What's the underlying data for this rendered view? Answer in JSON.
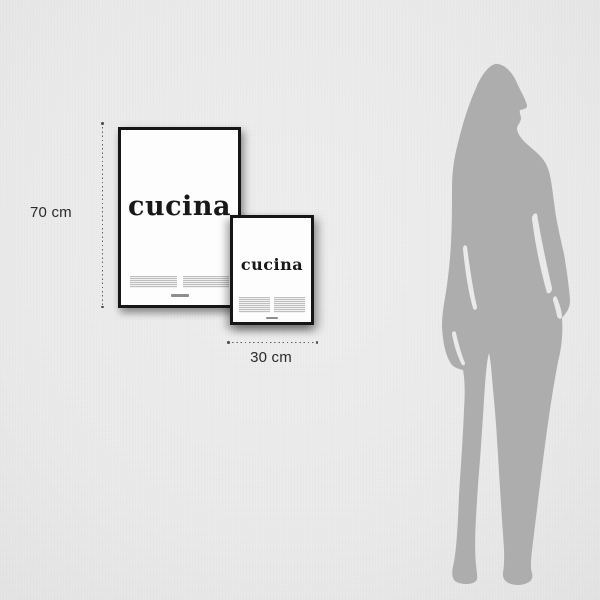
{
  "measurements": {
    "height_label": "70 cm",
    "width_label": "30 cm"
  },
  "posters": {
    "large": {
      "title": "cucina"
    },
    "small": {
      "title": "cucina"
    }
  },
  "colors": {
    "background": "#ececec",
    "frame": "#161616",
    "poster_paper": "#fdfdfd",
    "silhouette": "#adadad",
    "dimension_line": "#5f5f5f",
    "label_text": "#2a2a2a"
  },
  "icons": {
    "person_silhouette": "standing-woman-silhouette"
  }
}
